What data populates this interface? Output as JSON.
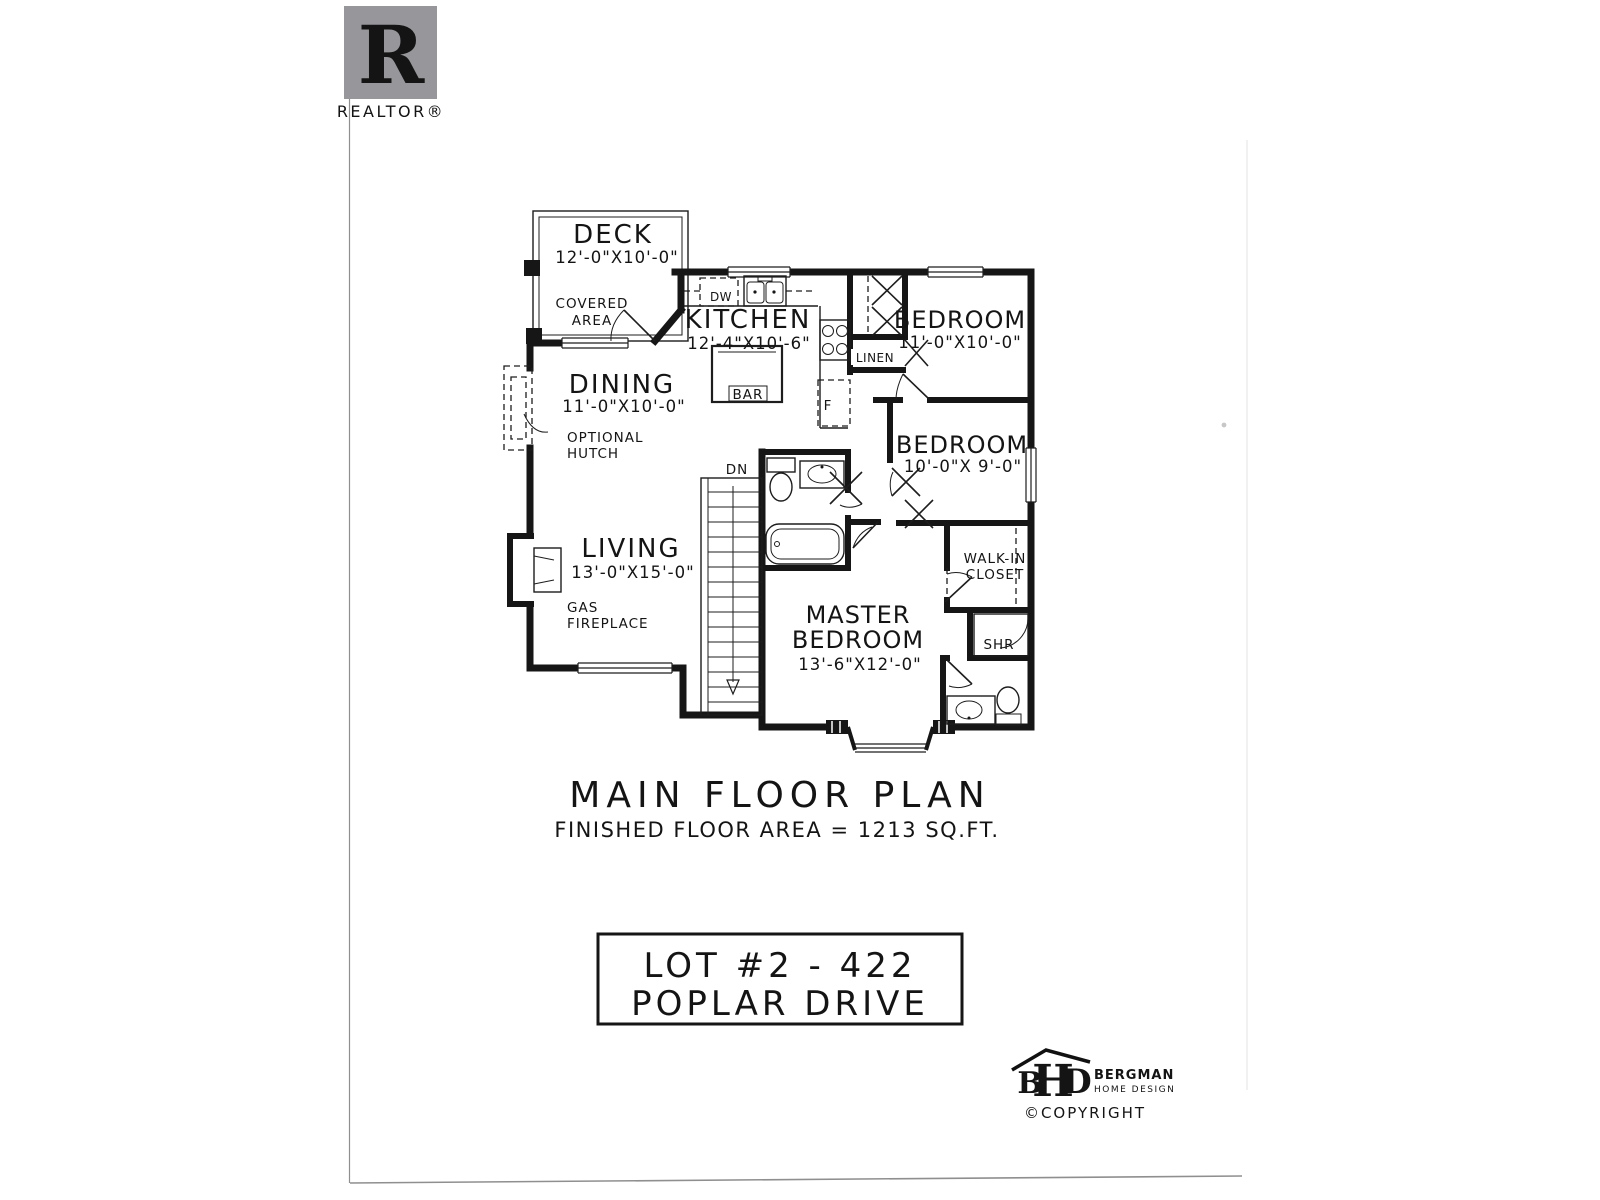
{
  "branding": {
    "realtor": {
      "letter": "R",
      "label": "REALTOR®",
      "gray": "#97979b"
    },
    "bergman": {
      "b": "B",
      "h": "H",
      "d": "D",
      "name": "BERGMAN",
      "tagline": "HOME DESIGN",
      "copyright": "©COPYRIGHT"
    }
  },
  "plan": {
    "title": "MAIN FLOOR PLAN",
    "subtitle": "FINISHED FLOOR AREA = 1213 SQ.FT.",
    "lot_line1": "LOT #2 - 422",
    "lot_line2": "POPLAR DRIVE"
  },
  "rooms": {
    "deck": {
      "name": "DECK",
      "dims": "12'-0\"X10'-0\""
    },
    "covered": {
      "line1": "COVERED",
      "line2": "AREA"
    },
    "kitchen": {
      "name": "KITCHEN",
      "dims": "12'-4\"X10'-6\""
    },
    "dining": {
      "name": "DINING",
      "dims": "11'-0\"X10'-0\""
    },
    "living": {
      "name": "LIVING",
      "dims": "13'-0\"X15'-0\""
    },
    "bedroom1": {
      "name": "BEDROOM",
      "dims": "11'-0\"X10'-0\""
    },
    "bedroom2": {
      "name": "BEDROOM",
      "dims": "10'-0\"X 9'-0\""
    },
    "master": {
      "line1": "MASTER",
      "line2": "BEDROOM",
      "dims": "13'-6\"X12'-0\""
    },
    "walkin": {
      "line1": "WALK-IN",
      "line2": "CLOSET"
    },
    "hutch": {
      "line1": "OPTIONAL",
      "line2": "HUTCH"
    },
    "fireplace": {
      "line1": "GAS",
      "line2": "FIREPLACE"
    },
    "linen": "LINEN",
    "shower": "SHR",
    "bar": "BAR",
    "dishwasher": "DW",
    "fridge": "F",
    "stairs_down": "DN"
  }
}
